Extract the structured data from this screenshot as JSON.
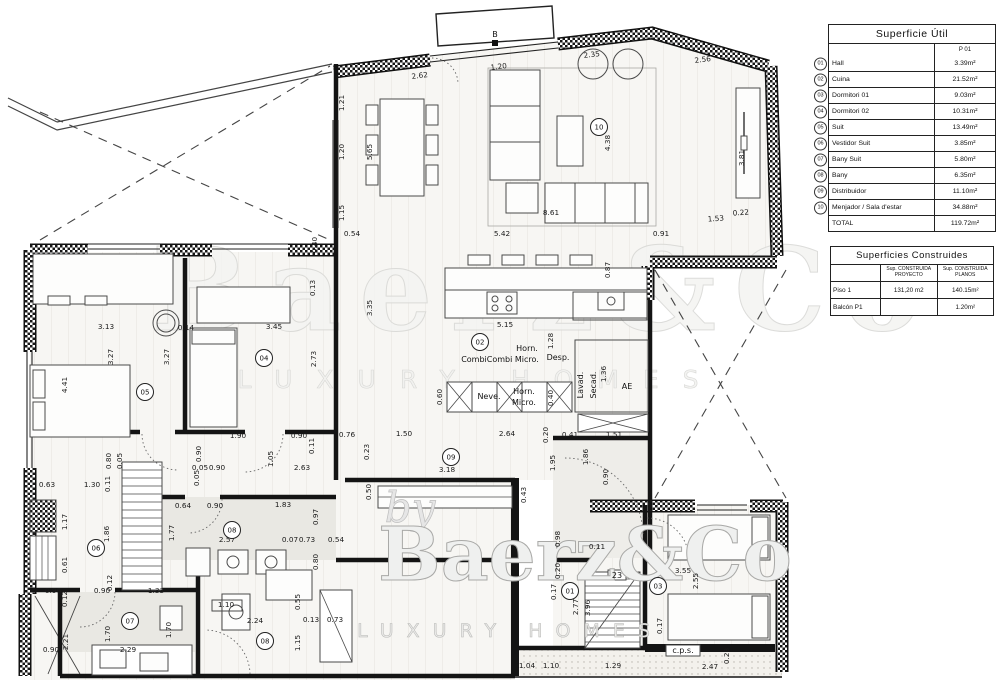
{
  "tables": {
    "superficie_util": {
      "title": "Superficie Útil",
      "col_header": "P 01",
      "rows": [
        {
          "num": "01",
          "name": "Hall",
          "value": "3.39m²"
        },
        {
          "num": "02",
          "name": "Cuina",
          "value": "21.52m²"
        },
        {
          "num": "03",
          "name": "Dormitori 01",
          "value": "9.03m²"
        },
        {
          "num": "04",
          "name": "Dormitori 02",
          "value": "10.31m²"
        },
        {
          "num": "05",
          "name": "Suit",
          "value": "13.49m²"
        },
        {
          "num": "06",
          "name": "Vestidor Suit",
          "value": "3.85m²"
        },
        {
          "num": "07",
          "name": "Bany Suit",
          "value": "5.80m²"
        },
        {
          "num": "08",
          "name": "Bany",
          "value": "6.35m²"
        },
        {
          "num": "09",
          "name": "Distribuidor",
          "value": "11.10m²"
        },
        {
          "num": "10",
          "name": "Menjador / Sala d'estar",
          "value": "34.88m²"
        }
      ],
      "total_label": "TOTAL",
      "total_value": "119.72m²"
    },
    "superficies_construides": {
      "title": "Superficies Construides",
      "col1_header": "Sup. CONSTRUIDA PROYECTO",
      "col2_header": "Sup. CONSTRUIDA PLANOS",
      "rows": [
        {
          "name": "Piso 1",
          "proyecto": "131,20 m2",
          "planos": "140.15m²"
        },
        {
          "name": "Balcón P1",
          "proyecto": "",
          "planos": "1.20m²"
        }
      ]
    }
  },
  "watermark": {
    "by": "by",
    "brand": "Baerz&Co",
    "tagline": "LUXURY HOMES"
  },
  "plan": {
    "rooms": [
      {
        "num": "01",
        "x": 570,
        "y": 591
      },
      {
        "num": "02",
        "x": 480,
        "y": 342
      },
      {
        "num": "03",
        "x": 658,
        "y": 586
      },
      {
        "num": "04",
        "x": 264,
        "y": 358
      },
      {
        "num": "05",
        "x": 145,
        "y": 392
      },
      {
        "num": "06",
        "x": 96,
        "y": 548
      },
      {
        "num": "07",
        "x": 130,
        "y": 621
      },
      {
        "num": "08",
        "x": 232,
        "y": 530
      },
      {
        "num": "08",
        "x": 265,
        "y": 641
      },
      {
        "num": "09",
        "x": 451,
        "y": 457
      },
      {
        "num": "10",
        "x": 599,
        "y": 127
      }
    ],
    "fixtures": [
      {
        "t": "Horn.",
        "x": 527,
        "y": 351
      },
      {
        "t": "CombiCombi Micro.",
        "x": 500,
        "y": 362
      },
      {
        "t": "Desp.",
        "x": 558,
        "y": 360
      },
      {
        "t": "Neve.",
        "x": 489,
        "y": 399
      },
      {
        "t": "Horn.",
        "x": 524,
        "y": 394
      },
      {
        "t": "Micro.",
        "x": 524,
        "y": 405
      },
      {
        "t": "Lavad.",
        "x": 583,
        "y": 385,
        "r": -90
      },
      {
        "t": "Secad.",
        "x": 596,
        "y": 385,
        "r": -90
      },
      {
        "t": "AE",
        "x": 627,
        "y": 389
      },
      {
        "t": "c.p.s.",
        "x": 683,
        "y": 653
      },
      {
        "t": "23",
        "x": 617,
        "y": 578
      },
      {
        "t": "B",
        "x": 495,
        "y": 37
      }
    ],
    "dims": [
      {
        "t": "2.62",
        "x": 420,
        "y": 78,
        "r": -7
      },
      {
        "t": "1.20",
        "x": 499,
        "y": 69,
        "r": -7
      },
      {
        "t": "2.35",
        "x": 592,
        "y": 57,
        "r": -7
      },
      {
        "t": "2.56",
        "x": 703,
        "y": 62,
        "r": -7
      },
      {
        "t": "1.21",
        "x": 344,
        "y": 103,
        "r": -90
      },
      {
        "t": "1.20",
        "x": 344,
        "y": 152,
        "r": -90
      },
      {
        "t": "1.15",
        "x": 344,
        "y": 213,
        "r": -90
      },
      {
        "t": "5.65",
        "x": 372,
        "y": 152,
        "r": -90
      },
      {
        "t": "4.38",
        "x": 610,
        "y": 143,
        "r": -90
      },
      {
        "t": "3.81",
        "x": 744,
        "y": 158,
        "r": -90
      },
      {
        "t": "8.61",
        "x": 551,
        "y": 215
      },
      {
        "t": "0.54",
        "x": 352,
        "y": 236
      },
      {
        "t": "5.42",
        "x": 502,
        "y": 236
      },
      {
        "t": "0.91",
        "x": 661,
        "y": 236
      },
      {
        "t": "1.53",
        "x": 716,
        "y": 221,
        "r": -4
      },
      {
        "t": "0.22",
        "x": 741,
        "y": 215,
        "r": -4
      },
      {
        "t": "0.40",
        "x": 317,
        "y": 245,
        "r": -90
      },
      {
        "t": "0.87",
        "x": 610,
        "y": 270,
        "r": -90
      },
      {
        "t": "3.35",
        "x": 372,
        "y": 308,
        "r": -90
      },
      {
        "t": "5.15",
        "x": 505,
        "y": 327
      },
      {
        "t": "1.28",
        "x": 553,
        "y": 341,
        "r": -90
      },
      {
        "t": "0.60",
        "x": 442,
        "y": 397,
        "r": -90
      },
      {
        "t": "0.40",
        "x": 553,
        "y": 398,
        "r": -90
      },
      {
        "t": "1.36",
        "x": 606,
        "y": 374,
        "r": -90
      },
      {
        "t": "0.76",
        "x": 347,
        "y": 437
      },
      {
        "t": "1.50",
        "x": 404,
        "y": 436
      },
      {
        "t": "2.64",
        "x": 507,
        "y": 436
      },
      {
        "t": "0.20",
        "x": 548,
        "y": 435,
        "r": -90
      },
      {
        "t": "0.41",
        "x": 570,
        "y": 437
      },
      {
        "t": "1.51",
        "x": 614,
        "y": 437
      },
      {
        "t": "0.23",
        "x": 369,
        "y": 452,
        "r": -90
      },
      {
        "t": "3.18",
        "x": 447,
        "y": 472
      },
      {
        "t": "0.50",
        "x": 371,
        "y": 492,
        "r": -90
      },
      {
        "t": "0.43",
        "x": 526,
        "y": 495,
        "r": -90
      },
      {
        "t": "1.95",
        "x": 555,
        "y": 463,
        "r": -90
      },
      {
        "t": "1.86",
        "x": 588,
        "y": 457,
        "r": -90
      },
      {
        "t": "0.90",
        "x": 608,
        "y": 477,
        "r": -90
      },
      {
        "t": "3.13",
        "x": 106,
        "y": 329
      },
      {
        "t": "0.14",
        "x": 186,
        "y": 330
      },
      {
        "t": "3.45",
        "x": 274,
        "y": 329
      },
      {
        "t": "3.27",
        "x": 113,
        "y": 357,
        "r": -90
      },
      {
        "t": "3.27",
        "x": 169,
        "y": 357,
        "r": -90
      },
      {
        "t": "4.41",
        "x": 67,
        "y": 385,
        "r": -90
      },
      {
        "t": "2.73",
        "x": 316,
        "y": 359,
        "r": -90
      },
      {
        "t": "0.13",
        "x": 315,
        "y": 288,
        "r": -90
      },
      {
        "t": "1.90",
        "x": 238,
        "y": 438
      },
      {
        "t": "0.90",
        "x": 299,
        "y": 438
      },
      {
        "t": "0.11",
        "x": 314,
        "y": 446,
        "r": -90
      },
      {
        "t": "1.05",
        "x": 273,
        "y": 459,
        "r": -90
      },
      {
        "t": "2.63",
        "x": 302,
        "y": 470
      },
      {
        "t": "0.90",
        "x": 217,
        "y": 470
      },
      {
        "t": "0.05",
        "x": 200,
        "y": 470
      },
      {
        "t": "0.90",
        "x": 201,
        "y": 454,
        "r": -90
      },
      {
        "t": "0.05",
        "x": 199,
        "y": 478,
        "r": -90
      },
      {
        "t": "0.80",
        "x": 111,
        "y": 461,
        "r": -90
      },
      {
        "t": "0.05",
        "x": 122,
        "y": 461,
        "r": -90
      },
      {
        "t": "1.30",
        "x": 92,
        "y": 487
      },
      {
        "t": "0.63",
        "x": 47,
        "y": 487
      },
      {
        "t": "0.11",
        "x": 110,
        "y": 484,
        "r": -90
      },
      {
        "t": "1.17",
        "x": 67,
        "y": 522,
        "r": -90
      },
      {
        "t": "1.86",
        "x": 109,
        "y": 534,
        "r": -90
      },
      {
        "t": "0.61",
        "x": 67,
        "y": 565,
        "r": -90
      },
      {
        "t": "0.12",
        "x": 112,
        "y": 583,
        "r": -90
      },
      {
        "t": "0.64",
        "x": 183,
        "y": 508
      },
      {
        "t": "0.90",
        "x": 215,
        "y": 508
      },
      {
        "t": "1.83",
        "x": 283,
        "y": 507
      },
      {
        "t": "0.97",
        "x": 318,
        "y": 517,
        "r": -90
      },
      {
        "t": "1.77",
        "x": 174,
        "y": 533,
        "r": -90
      },
      {
        "t": "2.57",
        "x": 227,
        "y": 542
      },
      {
        "t": "0.07",
        "x": 290,
        "y": 542
      },
      {
        "t": "0.73",
        "x": 307,
        "y": 542
      },
      {
        "t": "0.54",
        "x": 336,
        "y": 542
      },
      {
        "t": "0.80",
        "x": 318,
        "y": 562,
        "r": -90
      },
      {
        "t": "0.96",
        "x": 53,
        "y": 593
      },
      {
        "t": "0.12",
        "x": 67,
        "y": 599,
        "r": -90
      },
      {
        "t": "0.90",
        "x": 102,
        "y": 593
      },
      {
        "t": "1.33",
        "x": 156,
        "y": 593
      },
      {
        "t": "2.21",
        "x": 68,
        "y": 642,
        "r": -90
      },
      {
        "t": "0.90",
        "x": 51,
        "y": 652
      },
      {
        "t": "1.70",
        "x": 110,
        "y": 634,
        "r": -90
      },
      {
        "t": "1.70",
        "x": 171,
        "y": 630,
        "r": -90
      },
      {
        "t": "2.29",
        "x": 128,
        "y": 652
      },
      {
        "t": "1.10",
        "x": 226,
        "y": 607
      },
      {
        "t": "0.55",
        "x": 300,
        "y": 602,
        "r": -90
      },
      {
        "t": "2.24",
        "x": 255,
        "y": 623
      },
      {
        "t": "0.13",
        "x": 311,
        "y": 622
      },
      {
        "t": "0.73",
        "x": 335,
        "y": 622
      },
      {
        "t": "1.15",
        "x": 300,
        "y": 643,
        "r": -90
      },
      {
        "t": "0.98",
        "x": 560,
        "y": 539,
        "r": -90
      },
      {
        "t": "0.20",
        "x": 560,
        "y": 571,
        "r": -90
      },
      {
        "t": "0.11",
        "x": 597,
        "y": 549
      },
      {
        "t": "0.17",
        "x": 556,
        "y": 592,
        "r": -90
      },
      {
        "t": "2.77",
        "x": 578,
        "y": 607,
        "r": -90
      },
      {
        "t": "3.96",
        "x": 590,
        "y": 608,
        "r": -90
      },
      {
        "t": "1.04",
        "x": 527,
        "y": 668
      },
      {
        "t": "1.10",
        "x": 551,
        "y": 668
      },
      {
        "t": "1.29",
        "x": 613,
        "y": 668
      },
      {
        "t": "2.47",
        "x": 710,
        "y": 669
      },
      {
        "t": "0.28",
        "x": 729,
        "y": 656,
        "r": -90
      },
      {
        "t": "0.17",
        "x": 662,
        "y": 626,
        "r": -90
      },
      {
        "t": "3.55",
        "x": 683,
        "y": 573
      },
      {
        "t": "2.55",
        "x": 698,
        "y": 581,
        "r": -90
      }
    ]
  }
}
